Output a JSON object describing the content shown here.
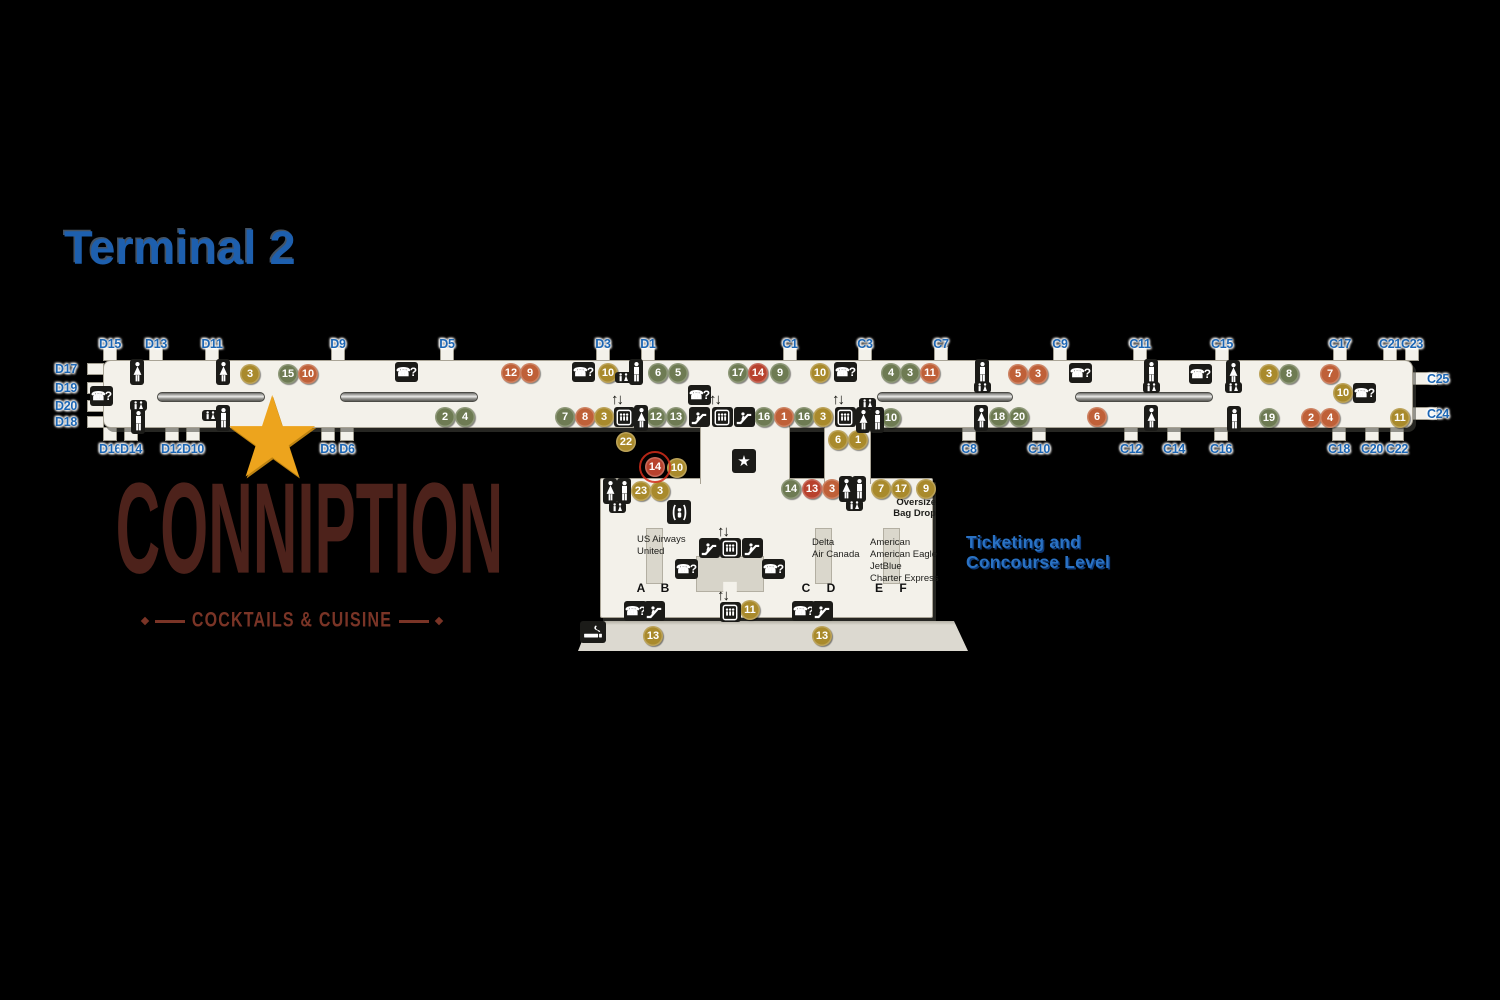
{
  "title": "Terminal 2",
  "level_caption": {
    "line1": "Ticketing and",
    "line2": "Concourse Level"
  },
  "logo": {
    "name": "CONNIPTION",
    "tagline": "COCKTAILS & CUISINE"
  },
  "ticketing": {
    "counters": [
      {
        "airlines": [
          "US Airways",
          "United"
        ],
        "doors": [
          "A",
          "B"
        ]
      },
      {
        "airlines": [
          "Delta",
          "Air Canada"
        ],
        "doors": [
          "C",
          "D"
        ]
      },
      {
        "airlines": [
          "American",
          "American Eagle",
          "JetBlue",
          "Charter Express"
        ],
        "doors": [
          "E",
          "F"
        ]
      }
    ],
    "oversize": [
      "Oversize",
      "Bag Drop"
    ]
  },
  "colors": {
    "background": "#000000",
    "floor": "#f3f1ea",
    "gate_blue": "#1c66b4",
    "title_blue": "#1d5fae",
    "badge_gold": "#a98a2c",
    "badge_green": "#6e7b53",
    "badge_orange": "#bf6038",
    "badge_red": "#b8422e",
    "aed_red": "#c4242c",
    "logo_brown": "#4d221b",
    "logo_accent": "#7a3426",
    "star_gold": "#eda41d"
  },
  "map": {
    "gates": {
      "top": [
        {
          "label": "D15",
          "x": 110
        },
        {
          "label": "D13",
          "x": 156
        },
        {
          "label": "D11",
          "x": 212
        },
        {
          "label": "D9",
          "x": 338
        },
        {
          "label": "D5",
          "x": 447
        },
        {
          "label": "D3",
          "x": 603
        },
        {
          "label": "D1",
          "x": 648
        },
        {
          "label": "C1",
          "x": 790
        },
        {
          "label": "C3",
          "x": 865
        },
        {
          "label": "C7",
          "x": 941
        },
        {
          "label": "C9",
          "x": 1060
        },
        {
          "label": "C11",
          "x": 1140
        },
        {
          "label": "C15",
          "x": 1222
        },
        {
          "label": "C17",
          "x": 1340
        },
        {
          "label": "C21",
          "x": 1390
        },
        {
          "label": "C23",
          "x": 1412
        }
      ],
      "bottom": [
        {
          "label": "D16",
          "x": 110
        },
        {
          "label": "D14",
          "x": 131
        },
        {
          "label": "D12",
          "x": 172
        },
        {
          "label": "D10",
          "x": 193
        },
        {
          "label": "D8",
          "x": 328
        },
        {
          "label": "D6",
          "x": 347
        },
        {
          "label": "C8",
          "x": 969
        },
        {
          "label": "C10",
          "x": 1039
        },
        {
          "label": "C12",
          "x": 1131
        },
        {
          "label": "C14",
          "x": 1174
        },
        {
          "label": "C16",
          "x": 1221
        },
        {
          "label": "C18",
          "x": 1339
        },
        {
          "label": "C20",
          "x": 1372
        },
        {
          "label": "C22",
          "x": 1397
        }
      ],
      "left": [
        {
          "label": "D17",
          "y": 369
        },
        {
          "label": "D19",
          "y": 388
        },
        {
          "label": "D20",
          "y": 406
        },
        {
          "label": "D18",
          "y": 422
        }
      ],
      "right": [
        {
          "label": "C25",
          "y": 379
        },
        {
          "label": "C24",
          "y": 414
        }
      ]
    },
    "badges": [
      {
        "n": "3",
        "c": "gold",
        "x": 250,
        "y": 374
      },
      {
        "n": "15",
        "c": "green",
        "x": 288,
        "y": 374
      },
      {
        "n": "10",
        "c": "orange",
        "x": 308,
        "y": 374
      },
      {
        "n": "12",
        "c": "orange",
        "x": 511,
        "y": 373
      },
      {
        "n": "9",
        "c": "orange",
        "x": 530,
        "y": 373
      },
      {
        "n": "10",
        "c": "gold",
        "x": 608,
        "y": 373
      },
      {
        "n": "6",
        "c": "green",
        "x": 658,
        "y": 373
      },
      {
        "n": "5",
        "c": "green",
        "x": 678,
        "y": 373
      },
      {
        "n": "17",
        "c": "green",
        "x": 738,
        "y": 373
      },
      {
        "n": "14",
        "c": "red",
        "x": 758,
        "y": 373
      },
      {
        "n": "9",
        "c": "green",
        "x": 780,
        "y": 373
      },
      {
        "n": "10",
        "c": "gold",
        "x": 820,
        "y": 373
      },
      {
        "n": "4",
        "c": "green",
        "x": 891,
        "y": 373
      },
      {
        "n": "3",
        "c": "green",
        "x": 910,
        "y": 373
      },
      {
        "n": "11",
        "c": "orange",
        "x": 930,
        "y": 373
      },
      {
        "n": "5",
        "c": "orange",
        "x": 1018,
        "y": 374
      },
      {
        "n": "3",
        "c": "orange",
        "x": 1038,
        "y": 374
      },
      {
        "n": "3",
        "c": "gold",
        "x": 1269,
        "y": 374
      },
      {
        "n": "8",
        "c": "green",
        "x": 1289,
        "y": 374
      },
      {
        "n": "7",
        "c": "orange",
        "x": 1330,
        "y": 374
      },
      {
        "n": "10",
        "c": "gold",
        "x": 1343,
        "y": 393
      },
      {
        "n": "2",
        "c": "green",
        "x": 445,
        "y": 417
      },
      {
        "n": "4",
        "c": "green",
        "x": 465,
        "y": 417
      },
      {
        "n": "7",
        "c": "green",
        "x": 565,
        "y": 417
      },
      {
        "n": "8",
        "c": "orange",
        "x": 585,
        "y": 417
      },
      {
        "n": "3",
        "c": "gold",
        "x": 604,
        "y": 417
      },
      {
        "n": "12",
        "c": "green",
        "x": 656,
        "y": 417
      },
      {
        "n": "13",
        "c": "green",
        "x": 676,
        "y": 417
      },
      {
        "n": "16",
        "c": "green",
        "x": 764,
        "y": 417
      },
      {
        "n": "1",
        "c": "orange",
        "x": 784,
        "y": 417
      },
      {
        "n": "16",
        "c": "green",
        "x": 804,
        "y": 417
      },
      {
        "n": "3",
        "c": "gold",
        "x": 823,
        "y": 417
      },
      {
        "n": "10",
        "c": "green",
        "x": 891,
        "y": 418
      },
      {
        "n": "18",
        "c": "green",
        "x": 999,
        "y": 417
      },
      {
        "n": "20",
        "c": "green",
        "x": 1019,
        "y": 417
      },
      {
        "n": "6",
        "c": "orange",
        "x": 1097,
        "y": 417
      },
      {
        "n": "19",
        "c": "green",
        "x": 1269,
        "y": 418
      },
      {
        "n": "2",
        "c": "orange",
        "x": 1311,
        "y": 418
      },
      {
        "n": "4",
        "c": "orange",
        "x": 1330,
        "y": 418
      },
      {
        "n": "11",
        "c": "gold",
        "x": 1400,
        "y": 418
      },
      {
        "n": "22",
        "c": "gold",
        "x": 626,
        "y": 442
      },
      {
        "n": "6",
        "c": "gold",
        "x": 838,
        "y": 440
      },
      {
        "n": "1",
        "c": "gold",
        "x": 858,
        "y": 440
      },
      {
        "n": "14",
        "c": "red",
        "x": 655,
        "y": 467,
        "ring": true
      },
      {
        "n": "10",
        "c": "gold",
        "x": 677,
        "y": 468
      },
      {
        "n": "23",
        "c": "gold",
        "x": 641,
        "y": 491
      },
      {
        "n": "3",
        "c": "gold",
        "x": 660,
        "y": 491
      },
      {
        "n": "14",
        "c": "green",
        "x": 791,
        "y": 489
      },
      {
        "n": "13",
        "c": "red",
        "x": 812,
        "y": 489
      },
      {
        "n": "3",
        "c": "orange",
        "x": 832,
        "y": 489
      },
      {
        "n": "7",
        "c": "gold",
        "x": 881,
        "y": 489
      },
      {
        "n": "17",
        "c": "gold",
        "x": 901,
        "y": 489
      },
      {
        "n": "9",
        "c": "gold",
        "x": 926,
        "y": 489
      },
      {
        "n": "11",
        "c": "gold",
        "x": 750,
        "y": 610
      },
      {
        "n": "13",
        "c": "gold",
        "x": 653,
        "y": 636
      },
      {
        "n": "13",
        "c": "gold",
        "x": 822,
        "y": 636
      }
    ],
    "icons": [
      {
        "t": "phone",
        "x": 101,
        "y": 396
      },
      {
        "t": "phone",
        "x": 406,
        "y": 372
      },
      {
        "t": "phone",
        "x": 583,
        "y": 372
      },
      {
        "t": "phone",
        "x": 845,
        "y": 372
      },
      {
        "t": "phone",
        "x": 1080,
        "y": 373
      },
      {
        "t": "phone",
        "x": 1200,
        "y": 374
      },
      {
        "t": "phone",
        "x": 1364,
        "y": 393
      },
      {
        "t": "phone",
        "x": 699,
        "y": 395
      },
      {
        "t": "phone",
        "x": 686,
        "y": 569
      },
      {
        "t": "phone",
        "x": 773,
        "y": 569
      },
      {
        "t": "phone",
        "x": 635,
        "y": 611
      },
      {
        "t": "phone",
        "x": 803,
        "y": 611
      },
      {
        "t": "esc",
        "x": 699,
        "y": 417
      },
      {
        "t": "esc",
        "x": 744,
        "y": 417
      },
      {
        "t": "esc",
        "x": 709,
        "y": 548
      },
      {
        "t": "esc",
        "x": 752,
        "y": 548
      },
      {
        "t": "esc",
        "x": 654,
        "y": 611
      },
      {
        "t": "esc",
        "x": 822,
        "y": 611
      },
      {
        "t": "elev",
        "x": 624,
        "y": 417
      },
      {
        "t": "elev",
        "x": 722,
        "y": 417
      },
      {
        "t": "elev",
        "x": 845,
        "y": 417
      },
      {
        "t": "elev",
        "x": 730,
        "y": 548
      },
      {
        "t": "elev",
        "x": 730,
        "y": 612
      },
      {
        "t": "arrows",
        "x": 624,
        "y": 400
      },
      {
        "t": "arrows",
        "x": 722,
        "y": 400
      },
      {
        "t": "arrows",
        "x": 845,
        "y": 400
      },
      {
        "t": "arrows",
        "x": 730,
        "y": 532
      },
      {
        "t": "arrows",
        "x": 730,
        "y": 596
      },
      {
        "t": "aed",
        "x": 327,
        "y": 373
      },
      {
        "t": "aed",
        "x": 1059,
        "y": 373
      },
      {
        "t": "aed",
        "x": 680,
        "y": 490
      },
      {
        "t": "wman",
        "x": 137,
        "y": 372
      },
      {
        "t": "wman",
        "x": 223,
        "y": 372
      },
      {
        "t": "wman",
        "x": 641,
        "y": 418
      },
      {
        "t": "wman",
        "x": 863,
        "y": 420
      },
      {
        "t": "wman",
        "x": 981,
        "y": 418
      },
      {
        "t": "wman",
        "x": 1151,
        "y": 418
      },
      {
        "t": "wman",
        "x": 1233,
        "y": 373
      },
      {
        "t": "wman",
        "x": 610,
        "y": 491
      },
      {
        "t": "wman",
        "x": 846,
        "y": 489
      },
      {
        "t": "man",
        "x": 138,
        "y": 421
      },
      {
        "t": "man",
        "x": 223,
        "y": 418
      },
      {
        "t": "man",
        "x": 636,
        "y": 372
      },
      {
        "t": "man",
        "x": 877,
        "y": 420
      },
      {
        "t": "man",
        "x": 982,
        "y": 372
      },
      {
        "t": "man",
        "x": 1151,
        "y": 372
      },
      {
        "t": "man",
        "x": 1234,
        "y": 419
      },
      {
        "t": "man",
        "x": 624,
        "y": 491
      },
      {
        "t": "man",
        "x": 859,
        "y": 489
      },
      {
        "t": "fam",
        "x": 138,
        "y": 405
      },
      {
        "t": "fam",
        "x": 210,
        "y": 415
      },
      {
        "t": "fam",
        "x": 623,
        "y": 377
      },
      {
        "t": "fam",
        "x": 867,
        "y": 403
      },
      {
        "t": "fam",
        "x": 982,
        "y": 387
      },
      {
        "t": "fam",
        "x": 1151,
        "y": 387
      },
      {
        "t": "fam",
        "x": 1233,
        "y": 387
      },
      {
        "t": "fam",
        "x": 617,
        "y": 507
      },
      {
        "t": "fam",
        "x": 854,
        "y": 505
      },
      {
        "t": "starbox",
        "x": 744,
        "y": 461
      },
      {
        "t": "smoke",
        "x": 593,
        "y": 632
      },
      {
        "t": "nurse",
        "x": 679,
        "y": 512
      },
      {
        "t": "bigstar",
        "x": 278,
        "y": 438
      }
    ],
    "walkways": [
      {
        "x1": 157,
        "x2": 265
      },
      {
        "x1": 340,
        "x2": 478
      },
      {
        "x1": 877,
        "x2": 1013
      },
      {
        "x1": 1075,
        "x2": 1213
      }
    ]
  }
}
